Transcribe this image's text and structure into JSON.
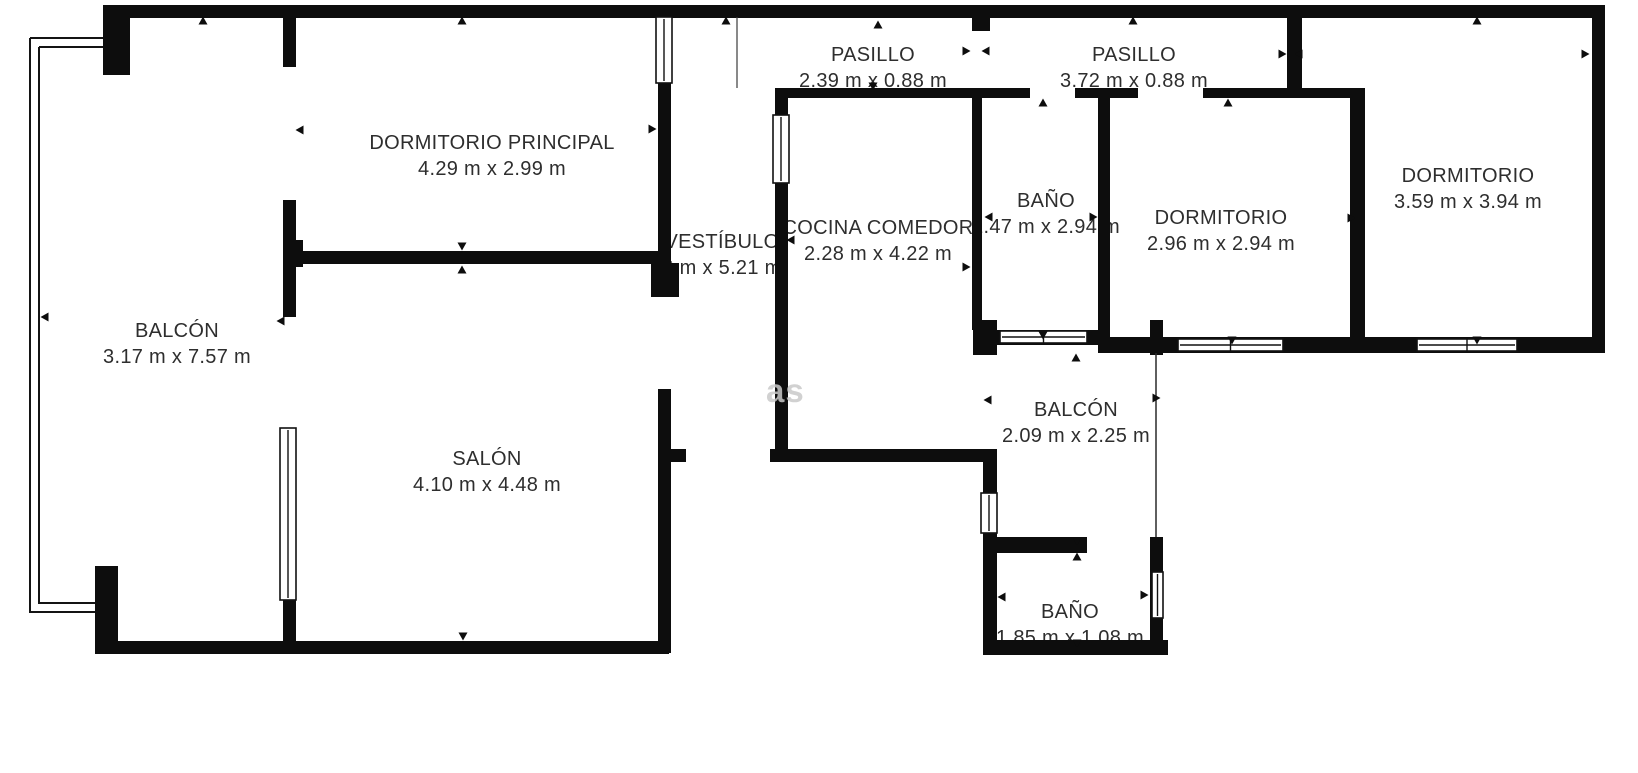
{
  "title": "Floor plan",
  "watermark": "as",
  "colors": {
    "wall": "#0d0d0d",
    "text": "#2e2e2e",
    "watermark": "#c9c9c9",
    "background": "#ffffff"
  },
  "rooms": [
    {
      "id": "dormitorio-principal",
      "name": "DORMITORIO PRINCIPAL",
      "dims": "4.29 m x 2.99 m"
    },
    {
      "id": "balcon-izquierdo",
      "name": "BALCÓN",
      "dims": "3.17 m x 7.57 m"
    },
    {
      "id": "salon",
      "name": "SALÓN",
      "dims": "4.10 m x 4.48 m"
    },
    {
      "id": "vestibulo",
      "name": "VESTÍBULO",
      "dims": "6 m x 5.21 m"
    },
    {
      "id": "cocina-comedor",
      "name": "COCINA COMEDOR",
      "dims": "2.28 m x 4.22 m"
    },
    {
      "id": "pasillo-1",
      "name": "PASILLO",
      "dims": "2.39 m x 0.88 m"
    },
    {
      "id": "pasillo-2",
      "name": "PASILLO",
      "dims": "3.72 m x 0.88 m"
    },
    {
      "id": "bano-1",
      "name": "BAÑO",
      "dims": "1.47 m x 2.94 m"
    },
    {
      "id": "dormitorio-2",
      "name": "DORMITORIO",
      "dims": "2.96 m x 2.94 m"
    },
    {
      "id": "dormitorio-3",
      "name": "DORMITORIO",
      "dims": "3.59 m x 3.94 m"
    },
    {
      "id": "balcon-central",
      "name": "BALCÓN",
      "dims": "2.09 m x 2.25 m"
    },
    {
      "id": "bano-2",
      "name": "BAÑO",
      "dims": "1.85 m x 1.08 m"
    }
  ]
}
